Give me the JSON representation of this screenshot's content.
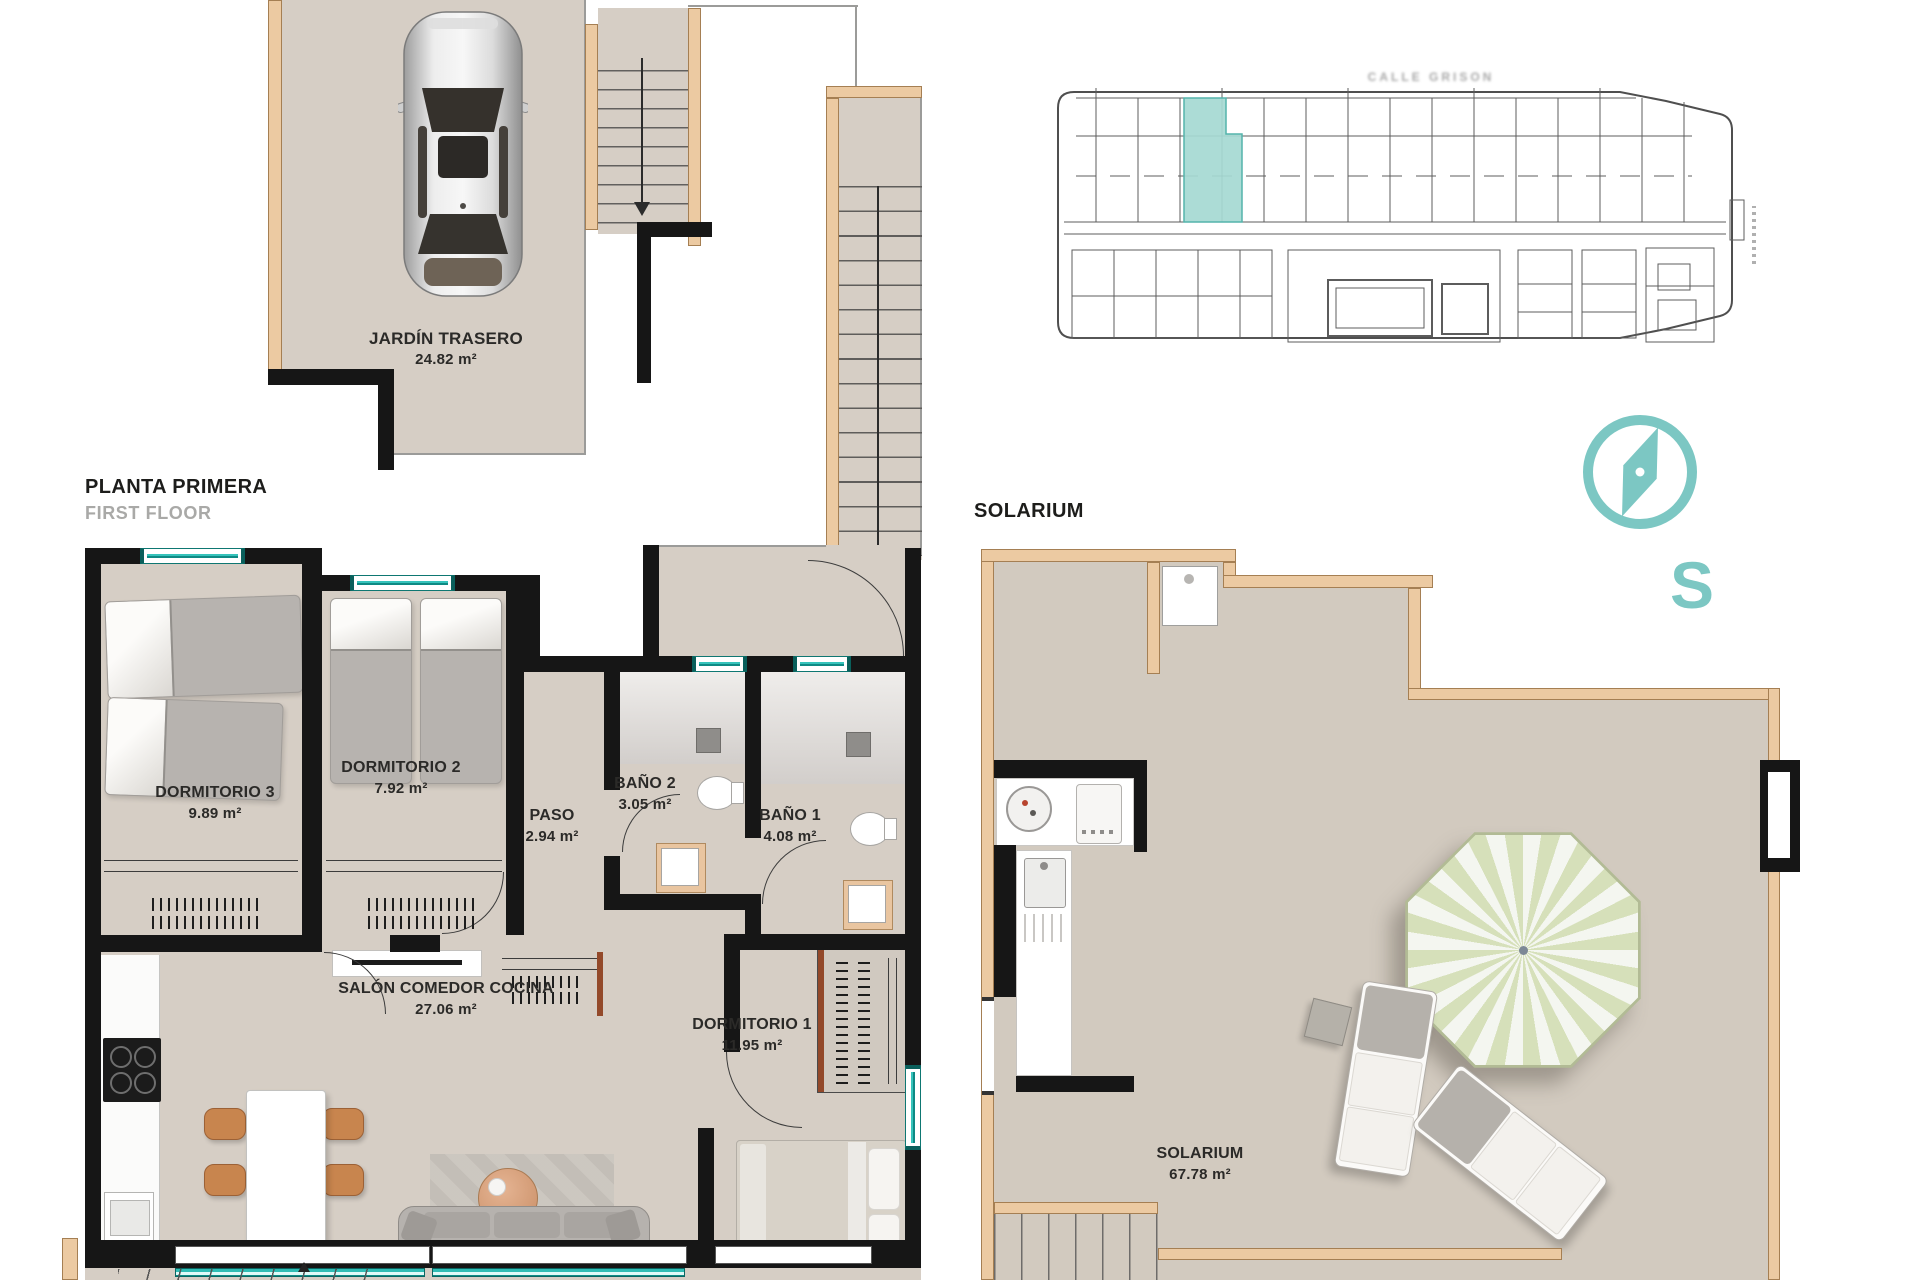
{
  "titles": {
    "floor_plan_title": "PLANTA PRIMERA",
    "floor_plan_subtitle": "FIRST FLOOR",
    "solarium_title": "SOLARIUM"
  },
  "rooms": {
    "jardin": {
      "name": "JARDÍN TRASERO",
      "area": "24.82 m²"
    },
    "dormitorio3": {
      "name": "DORMITORIO 3",
      "area": "9.89 m²"
    },
    "dormitorio2": {
      "name": "DORMITORIO 2",
      "area": "7.92 m²"
    },
    "paso": {
      "name": "PASO",
      "area": "2.94 m²"
    },
    "bano2": {
      "name": "BAÑO 2",
      "area": "3.05 m²"
    },
    "bano1": {
      "name": "BAÑO 1",
      "area": "4.08 m²"
    },
    "salon": {
      "name": "SALÓN COMEDOR COCINA",
      "area": "27.06 m²"
    },
    "dormitorio1": {
      "name": "DORMITORIO 1",
      "area": "11.95 m²"
    },
    "solarium": {
      "name": "SOLARIUM",
      "area": "67.78 m²"
    }
  },
  "site_plan": {
    "street_label": "CALLE GRISON",
    "highlight_color": "#a5d9d3"
  },
  "compass": {
    "south_letter": "S",
    "color": "#7cc7c3"
  },
  "colors": {
    "floor_beige": "#d6cec5",
    "wall_black": "#161616",
    "accent_tan": "#eccaa2",
    "window_teal": "#2fbdb5"
  }
}
